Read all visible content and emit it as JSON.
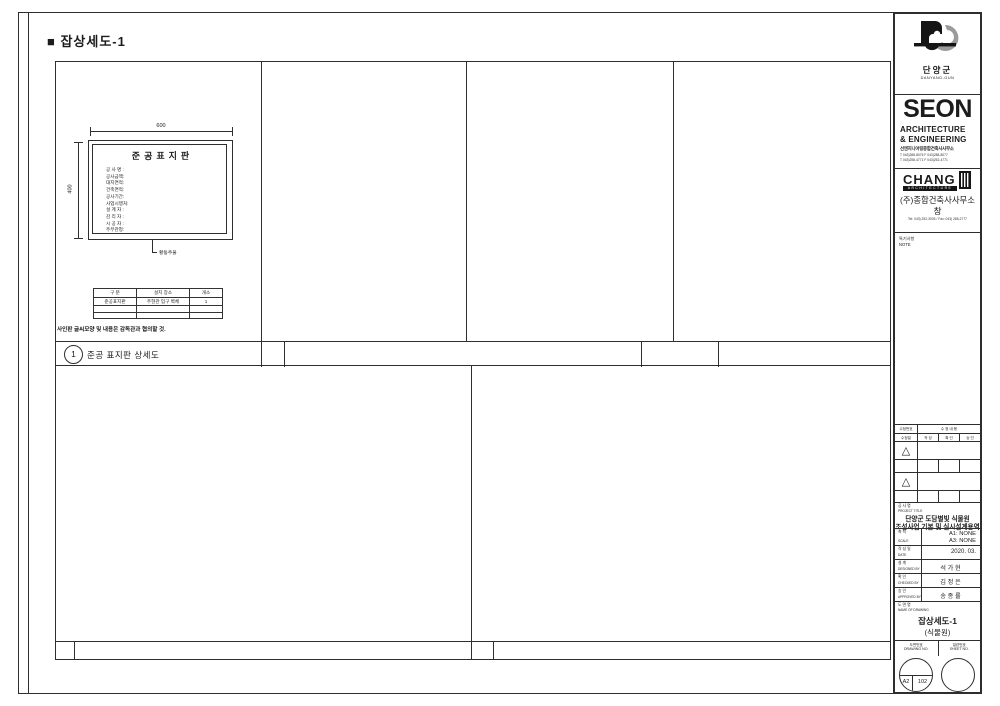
{
  "page": {
    "title": "■ 잡상세도-1"
  },
  "panel": {
    "detail_number": "1",
    "detail_title": "준공 표지판 상세도"
  },
  "signboard": {
    "title": "준공표지판",
    "items": [
      "공 사 명 :",
      "공사금액:",
      "대지면적:",
      "건축면적:",
      "공사기간:",
      "사업시행처:",
      "설 계 자 :",
      "감 리 자 :",
      "시 공 자 :",
      "주무관청:"
    ],
    "dim_width": "600",
    "dim_height": "400",
    "leader_label": "황동주물"
  },
  "spec_table": {
    "headers": [
      "구 분",
      "설치 장소",
      "개소"
    ],
    "rows": [
      [
        "준공표지판",
        "주현관 입구 벽체",
        "1"
      ],
      [
        "",
        "",
        ""
      ],
      [
        "",
        "",
        ""
      ]
    ]
  },
  "note": "사인판 글씨모양 및 내용은 감독관과 협의할 것.",
  "titleblock": {
    "client": {
      "name": "단양군",
      "name_en": "DANYANG-GUN"
    },
    "seon": {
      "wordmark": "SEON",
      "line1": "ARCHITECTURE",
      "line2": "& ENGINEERING",
      "company": "선엔지니어링종합건축사사무소",
      "contact1": "T 043)288-8076  F 043)288-8077",
      "contact2": "T 043)258-4771  F 043)252-4771"
    },
    "chang": {
      "wordmark": "CHANG",
      "sub": "ARCHITECTURE",
      "company": "(주)종합건축사사무소",
      "company2": "창",
      "tel": "Tel: 043) 252-3005 / Fax: 043) 285-2777"
    },
    "note_label": {
      "ko": "특기사항",
      "en": "NOTE"
    },
    "revisions": {
      "col_no": "수정번호",
      "col_desc": "수  정  내  용",
      "col_date": "수정일",
      "col_a": "작 성",
      "col_b": "확 인",
      "col_c": "승 인",
      "delta": "△"
    },
    "project": {
      "label_ko": "공  사  명",
      "label_en": "PROJECT TITLE",
      "title1": "단양군 도담별빛 식물원",
      "title2": "조성사업 기본 및 실시설계용역"
    },
    "fields": [
      {
        "ko": "축   척",
        "en": "SCALE",
        "value": "A1: NONE",
        "value2": "A3: NONE"
      },
      {
        "ko": "작 성 일",
        "en": "DATE",
        "value": "2020. 03.",
        "value2": ""
      },
      {
        "ko": "설   계",
        "en": "DESIGNED BY",
        "value": "석 가 현",
        "value2": ""
      },
      {
        "ko": "확   인",
        "en": "CHECKED BY",
        "value": "김 정 은",
        "value2": ""
      },
      {
        "ko": "승   인",
        "en": "APPROVED BY",
        "value": "송 종 률",
        "value2": ""
      }
    ],
    "drawing": {
      "label_ko": "도 면 명",
      "label_en": "NAME OF DRAWING",
      "name1": "잡상세도-1",
      "name2": "(식물원)"
    },
    "numbers": {
      "drawing_no_ko": "도면번호",
      "drawing_no_en": "DRAWING NO.",
      "sheet_no_ko": "일련번호",
      "sheet_no_en": "SHEET NO.",
      "drawing_no_a": "A2",
      "drawing_no_b": "102"
    }
  }
}
